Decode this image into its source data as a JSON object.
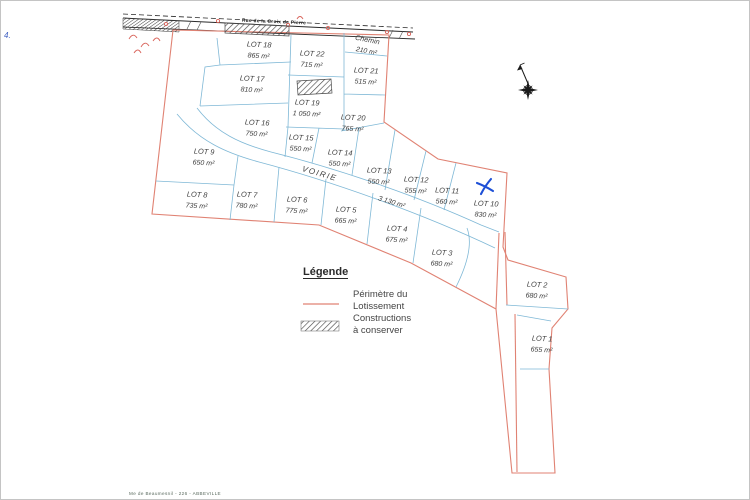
{
  "colors": {
    "perimeter_red": "#e08273",
    "lot_line_blue": "#7fb8d6",
    "ink": "#3c3c3c",
    "construction_hatch": "#4a4a4a",
    "mark_blue": "#1d4fd6",
    "road_black": "#2a2a2a"
  },
  "road": {
    "name": "Rue de la Croix de Pierre"
  },
  "chemin": {
    "name": "Chemin",
    "area": "210 m²"
  },
  "voirie": {
    "name": "VOIRIE",
    "area": "3 130 m²"
  },
  "lots": [
    {
      "name": "LOT 1",
      "area": "655 m²",
      "x": 541,
      "y": 340
    },
    {
      "name": "LOT 2",
      "area": "680 m²",
      "x": 536,
      "y": 286
    },
    {
      "name": "LOT 3",
      "area": "680 m²",
      "x": 441,
      "y": 254
    },
    {
      "name": "LOT 4",
      "area": "675 m²",
      "x": 396,
      "y": 230
    },
    {
      "name": "LOT 5",
      "area": "665 m²",
      "x": 345,
      "y": 211
    },
    {
      "name": "LOT 6",
      "area": "775 m²",
      "x": 296,
      "y": 201
    },
    {
      "name": "LOT 7",
      "area": "780 m²",
      "x": 246,
      "y": 196
    },
    {
      "name": "LOT 8",
      "area": "735 m²",
      "x": 196,
      "y": 196
    },
    {
      "name": "LOT 9",
      "area": "650 m²",
      "x": 203,
      "y": 153
    },
    {
      "name": "LOT 10",
      "area": "830 m²",
      "x": 485,
      "y": 205
    },
    {
      "name": "LOT 11",
      "area": "560 m²",
      "x": 446,
      "y": 192
    },
    {
      "name": "LOT 12",
      "area": "555 m²",
      "x": 415,
      "y": 181
    },
    {
      "name": "LOT 13",
      "area": "550 m²",
      "x": 378,
      "y": 172
    },
    {
      "name": "LOT 14",
      "area": "550 m²",
      "x": 339,
      "y": 154
    },
    {
      "name": "LOT 15",
      "area": "550 m²",
      "x": 300,
      "y": 139
    },
    {
      "name": "LOT 16",
      "area": "750 m²",
      "x": 256,
      "y": 124
    },
    {
      "name": "LOT 17",
      "area": "810 m²",
      "x": 251,
      "y": 80
    },
    {
      "name": "LOT 18",
      "area": "865 m²",
      "x": 258,
      "y": 46
    },
    {
      "name": "LOT 19",
      "area": "1 050 m²",
      "x": 306,
      "y": 104
    },
    {
      "name": "LOT 20",
      "area": "765 m²",
      "x": 352,
      "y": 119
    },
    {
      "name": "LOT 21",
      "area": "515 m²",
      "x": 365,
      "y": 72
    },
    {
      "name": "LOT 22",
      "area": "715 m²",
      "x": 311,
      "y": 55
    }
  ],
  "legend": {
    "title": "Légende",
    "items": [
      {
        "symbol": "red-line",
        "lines": [
          "Périmètre du",
          "Lotissement"
        ]
      },
      {
        "symbol": "hatch",
        "lines": [
          "Constructions",
          "à conserver"
        ]
      }
    ]
  },
  "annotations": {
    "corner_mark": "4.",
    "footer": "Me de Beaumesnil    - 226 -    ABBEVILLE"
  }
}
